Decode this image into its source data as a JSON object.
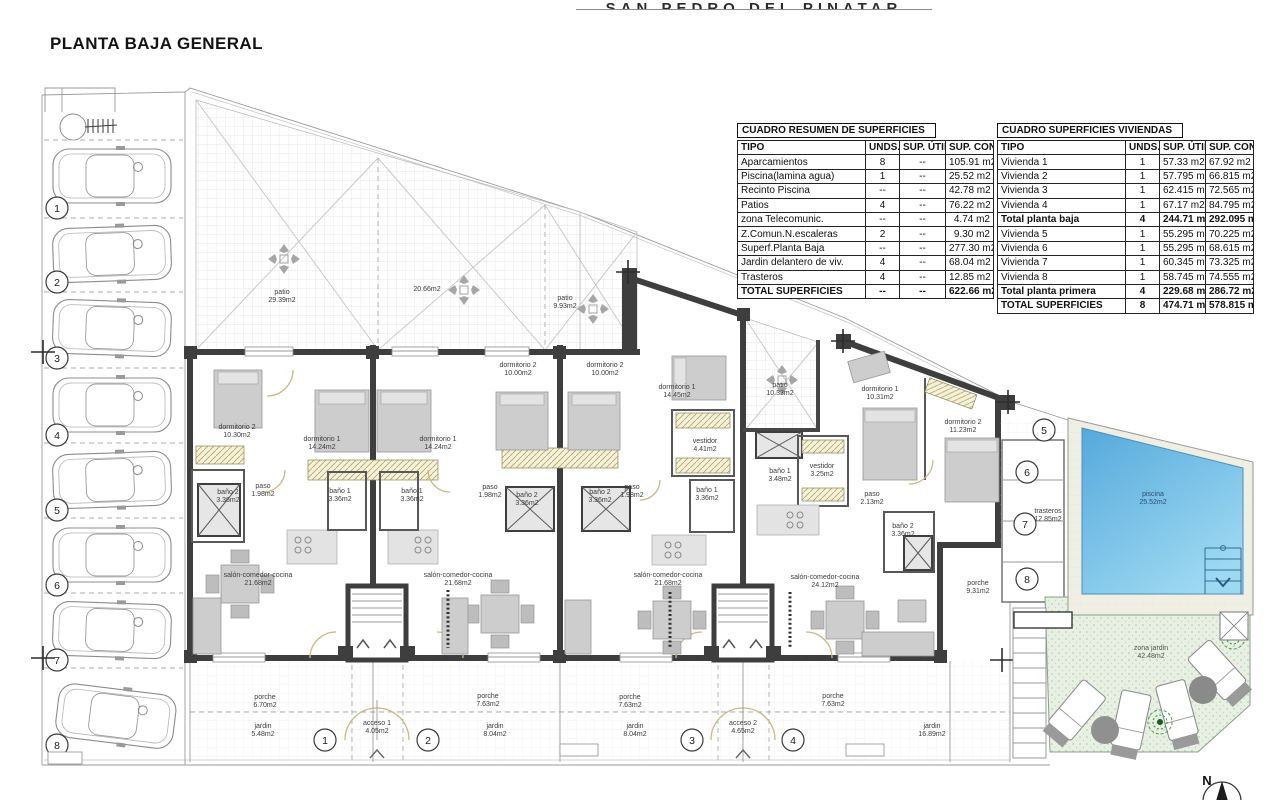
{
  "page": {
    "title": "PLANTA BAJA GENERAL",
    "header_title": "SAN PEDRO DEL PINATAR"
  },
  "tables": {
    "resumen": {
      "title": "CUADRO RESUMEN DE SUPERFICIES",
      "columns": [
        "TIPO",
        "UNDS.",
        "SUP. ÚTIL",
        "SUP. CONST."
      ],
      "rows": [
        [
          "Aparcamientos",
          "8",
          "--",
          "105.91 m2"
        ],
        [
          "Piscina(lamina agua)",
          "1",
          "--",
          "25.52 m2"
        ],
        [
          "Recinto Piscina",
          "--",
          "--",
          "42.78 m2"
        ],
        [
          "Patios",
          "4",
          "--",
          "76.22 m2"
        ],
        [
          "zona Telecomunic.",
          "--",
          "--",
          "4.74 m2"
        ],
        [
          "Z.Comun.N.escaleras",
          "2",
          "--",
          "9.30 m2"
        ],
        [
          "Superf.Planta Baja",
          "--",
          "--",
          "277.30 m2"
        ],
        [
          "Jardin delantero de viv.",
          "4",
          "--",
          "68.04 m2"
        ],
        [
          "Trasteros",
          "4",
          "--",
          "12.85 m2"
        ],
        [
          "TOTAL SUPERFICIES",
          "--",
          "--",
          "622.66 m2"
        ]
      ]
    },
    "viviendas": {
      "title": "CUADRO SUPERFICIES VIVIENDAS",
      "columns": [
        "TIPO",
        "UNDS.",
        "SUP. ÚTIL",
        "SUP. CONST."
      ],
      "rows": [
        [
          "Vivienda 1",
          "1",
          "57.33 m2",
          "67.92 m2"
        ],
        [
          "Vivienda 2",
          "1",
          "57.795 m2",
          "66.815 m2"
        ],
        [
          "Vivienda 3",
          "1",
          "62.415 m2",
          "72.565 m2"
        ],
        [
          "Vivienda 4",
          "1",
          "67.17 m2",
          "84.795 m2"
        ],
        [
          "Total planta baja",
          "4",
          "244.71 m2",
          "292.095 m2"
        ],
        [
          "Vivienda 5",
          "1",
          "55.295 m2",
          "70.225 m2"
        ],
        [
          "Vivienda 6",
          "1",
          "55.295 m2",
          "68.615 m2"
        ],
        [
          "Vivienda 7",
          "1",
          "60.345 m2",
          "73.325 m2"
        ],
        [
          "Vivienda 8",
          "1",
          "58.745 m2",
          "74.555 m2"
        ],
        [
          "Total planta primera",
          "4",
          "229.68 m2",
          "286.72 m2"
        ],
        [
          "TOTAL SUPERFICIES",
          "8",
          "474.71 m2",
          "578.815 m2"
        ]
      ]
    }
  },
  "plan": {
    "labels": [
      {
        "n": "patio",
        "a": "29.39m2"
      },
      {
        "n": "20.66m2",
        "a": ""
      },
      {
        "n": "patio",
        "a": "9.93m2"
      },
      {
        "n": "patio",
        "a": "10.33m2"
      },
      {
        "n": "dormitorio 2",
        "a": "10.30m2"
      },
      {
        "n": "dormitorio 1",
        "a": "14.24m2"
      },
      {
        "n": "dormitorio 1",
        "a": "14.24m2"
      },
      {
        "n": "dormitorio 2",
        "a": "10.00m2"
      },
      {
        "n": "dormitorio 2",
        "a": "10.00m2"
      },
      {
        "n": "dormitorio 1",
        "a": "14.45m2"
      },
      {
        "n": "dormitorio 1",
        "a": "10.31m2"
      },
      {
        "n": "dormitorio 2",
        "a": "11.23m2"
      },
      {
        "n": "baño 2",
        "a": "3.36m2"
      },
      {
        "n": "paso",
        "a": "1.98m2"
      },
      {
        "n": "baño 1",
        "a": "3.36m2"
      },
      {
        "n": "baño 1",
        "a": "3.36m2"
      },
      {
        "n": "paso",
        "a": "1.98m2"
      },
      {
        "n": "baño 2",
        "a": "3.36m2"
      },
      {
        "n": "baño 2",
        "a": "3.36m2"
      },
      {
        "n": "paso",
        "a": "1.98m2"
      },
      {
        "n": "vestidor",
        "a": "4.41m2"
      },
      {
        "n": "baño 1",
        "a": "3.36m2"
      },
      {
        "n": "baño 1",
        "a": "3.48m2"
      },
      {
        "n": "vestidor",
        "a": "3.25m2"
      },
      {
        "n": "paso",
        "a": "2.13m2"
      },
      {
        "n": "baño 2",
        "a": "3.36m2"
      },
      {
        "n": "salón-comedor-cocina",
        "a": "21.68m2"
      },
      {
        "n": "salón-comedor-cocina",
        "a": "21.68m2"
      },
      {
        "n": "salón-comedor-cocina",
        "a": "21.68m2"
      },
      {
        "n": "salón-comedor-cocina",
        "a": "24.12m2"
      },
      {
        "n": "porche",
        "a": "6.70m2"
      },
      {
        "n": "porche",
        "a": "7.63m2"
      },
      {
        "n": "porche",
        "a": "7.63m2"
      },
      {
        "n": "porche",
        "a": "7.63m2"
      },
      {
        "n": "porche",
        "a": "9.31m2"
      },
      {
        "n": "jardin",
        "a": "5.48m2"
      },
      {
        "n": "acceso 1",
        "a": "4.05m2"
      },
      {
        "n": "jardin",
        "a": "8.04m2"
      },
      {
        "n": "jardin",
        "a": "8.04m2"
      },
      {
        "n": "acceso 2",
        "a": "4.65m2"
      },
      {
        "n": "jardin",
        "a": "16.89m2"
      },
      {
        "n": "trasteros",
        "a": "12.85m2"
      },
      {
        "n": "piscina",
        "a": "25.52m2"
      },
      {
        "n": "zona jardin",
        "a": "42.48m2"
      }
    ],
    "parking_numbers": [
      "1",
      "2",
      "3",
      "4",
      "5",
      "6",
      "7",
      "8"
    ],
    "trastero_numbers": [
      "5",
      "6",
      "7",
      "8"
    ],
    "acceso_numbers": [
      "1",
      "2",
      "3",
      "4"
    ],
    "compass": "N",
    "colors": {
      "pool_top": "#55a9dc",
      "pool_bottom": "#9ed9f2",
      "garden": "#e7f0e3"
    }
  }
}
